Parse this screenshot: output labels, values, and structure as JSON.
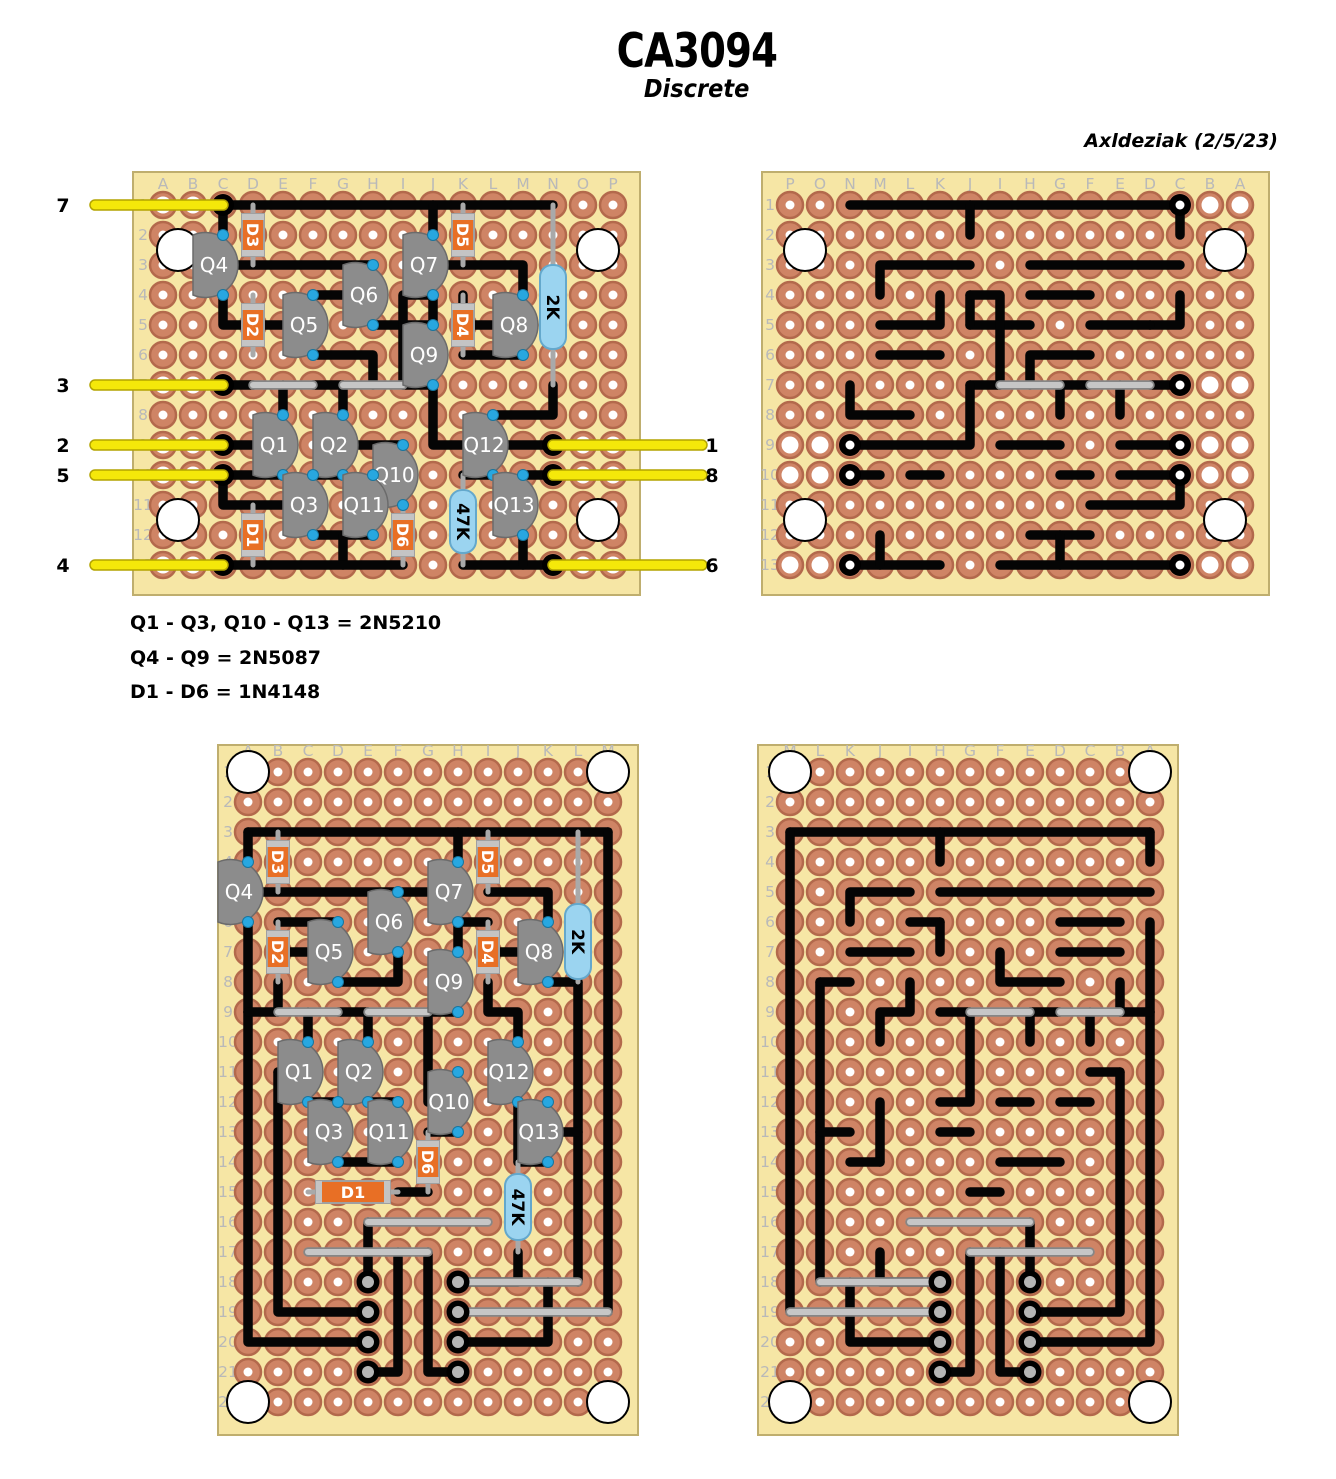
{
  "title": "CA3094",
  "subtitle": "Discrete",
  "author": "Axldeziak (2/5/23)",
  "legend": [
    "Q1 - Q3, Q10 - Q13 = 2N5210",
    "Q4 - Q9 = 2N5087",
    "D1 - D6 = 1N4148"
  ],
  "colors": {
    "board": "#f6e6a5",
    "boardEdge": "#bfae6e",
    "pad": "#cf8465",
    "padEdge": "#b3694c",
    "hole": "#ffffff",
    "trace": "#050505",
    "jumperUnder": "#868686",
    "jumperOver": "#c6c6c6",
    "yellowUnder": "#b3a400",
    "yellowOver": "#f5e80a",
    "transistor": "#8c8c8c",
    "transistorEdge": "#6b6b6b",
    "leadDot": "#28a7e0",
    "leadDotEdge": "#16759f",
    "diodeBody": "#e86f25",
    "diodeEdge": "#a0a0a0",
    "diodeBand": "#c4c4c4",
    "componentLead": "#a9a9a9",
    "resistorBody": "#9bd4f0",
    "resistorEdge": "#64a8cc",
    "terminalCenter": "#b5b5b5",
    "gridLabel": "#b9b9b9",
    "pinLabel": "#000000"
  },
  "boards": [
    {
      "name": "top-left",
      "ox": 133,
      "oy": 172,
      "w": 507,
      "h": 423,
      "cols": "ABCDEFGHIJKLMNOP",
      "nRows": 13,
      "colStart": 163,
      "rowStart": 205,
      "mirror": false,
      "holes": [
        [
          0.5,
          2.5
        ],
        [
          14.5,
          2.5
        ],
        [
          0.5,
          11.5
        ],
        [
          14.5,
          11.5
        ]
      ],
      "wirePads": [
        "A1",
        "B1",
        "A7",
        "B7",
        "A9",
        "B9",
        "O9",
        "P9",
        "A10",
        "B10",
        "O10",
        "P10",
        "A13",
        "B13",
        "O13",
        "P13"
      ],
      "traces": [
        [
          "C1",
          "N1"
        ],
        [
          "C1",
          "C2"
        ],
        [
          "J1",
          "J2"
        ],
        [
          "C3",
          "H3"
        ],
        [
          "J3",
          "M3",
          "M4"
        ],
        [
          "F4",
          "H4"
        ],
        [
          "C4",
          "C5",
          "D5"
        ],
        [
          "D5",
          "F5"
        ],
        [
          "F6",
          "H6",
          "H7"
        ],
        [
          "H5",
          "J5"
        ],
        [
          "J4",
          "J5"
        ],
        [
          "J4",
          "I4",
          "I7"
        ],
        [
          "M5",
          "K5",
          "K4"
        ],
        [
          "K6",
          "M6"
        ],
        [
          "N7",
          "N8",
          "L8"
        ],
        [
          "C7",
          "D7"
        ],
        [
          "F7",
          "G7"
        ],
        [
          "I7",
          "J7"
        ],
        [
          "J7",
          "J9",
          "N9"
        ],
        [
          "E7",
          "E8"
        ],
        [
          "G7",
          "G8"
        ],
        [
          "C9",
          "E9"
        ],
        [
          "G9",
          "I9"
        ],
        [
          "C10",
          "E10"
        ],
        [
          "C10",
          "C11",
          "F11"
        ],
        [
          "N10",
          "M10"
        ],
        [
          "L10",
          "K10"
        ],
        [
          "F10",
          "G10"
        ],
        [
          "F12",
          "H12"
        ],
        [
          "G12",
          "G13"
        ],
        [
          "C13",
          "I13"
        ],
        [
          "K13",
          "N13"
        ],
        [
          "M12",
          "M13"
        ]
      ],
      "jumpers": [
        [
          "D7",
          "F7"
        ],
        [
          "G7",
          "I7"
        ]
      ],
      "grayWires": [],
      "transistors": [
        {
          "l": "Q4",
          "c": "C",
          "r": 2
        },
        {
          "l": "Q7",
          "c": "J",
          "r": 2
        },
        {
          "l": "Q6",
          "c": "H",
          "r": 3
        },
        {
          "l": "Q5",
          "c": "F",
          "r": 4
        },
        {
          "l": "Q8",
          "c": "M",
          "r": 4
        },
        {
          "l": "Q9",
          "c": "J",
          "r": 5
        },
        {
          "l": "Q1",
          "c": "E",
          "r": 8
        },
        {
          "l": "Q2",
          "c": "G",
          "r": 8
        },
        {
          "l": "Q12",
          "c": "L",
          "r": 8
        },
        {
          "l": "Q10",
          "c": "I",
          "r": 9
        },
        {
          "l": "Q3",
          "c": "F",
          "r": 10
        },
        {
          "l": "Q11",
          "c": "H",
          "r": 10
        },
        {
          "l": "Q13",
          "c": "M",
          "r": 10
        }
      ],
      "diodes": [
        {
          "l": "D3",
          "c": "D",
          "r": 1,
          "h": false
        },
        {
          "l": "D5",
          "c": "K",
          "r": 1,
          "h": false
        },
        {
          "l": "D2",
          "c": "D",
          "r": 4,
          "h": false
        },
        {
          "l": "D4",
          "c": "K",
          "r": 4,
          "h": false
        },
        {
          "l": "D1",
          "c": "D",
          "r": 11,
          "h": false
        },
        {
          "l": "D6",
          "c": "I",
          "r": 11,
          "h": false
        }
      ],
      "resistors": [
        {
          "l": "2K",
          "c": "N",
          "r": 1,
          "span": 6,
          "b0": 2.0,
          "b1": 4.8
        },
        {
          "l": "47K",
          "c": "K",
          "r": 10,
          "span": 3,
          "b0": 0.5,
          "b1": 2.6
        }
      ],
      "pins": [
        {
          "l": "7",
          "c": "C",
          "r": 1,
          "s": "L"
        },
        {
          "l": "3",
          "c": "C",
          "r": 7,
          "s": "L"
        },
        {
          "l": "2",
          "c": "C",
          "r": 9,
          "s": "L"
        },
        {
          "l": "5",
          "c": "C",
          "r": 10,
          "s": "L"
        },
        {
          "l": "4",
          "c": "C",
          "r": 13,
          "s": "L"
        },
        {
          "l": "1",
          "c": "N",
          "r": 9,
          "s": "R"
        },
        {
          "l": "8",
          "c": "N",
          "r": 10,
          "s": "R"
        },
        {
          "l": "6",
          "c": "N",
          "r": 13,
          "s": "R"
        }
      ],
      "terminals": []
    },
    {
      "name": "top-right",
      "use": "top-left",
      "ox": 762,
      "oy": 172,
      "w": 507,
      "h": 423,
      "colStart": 790,
      "rowStart": 205,
      "mirror": true,
      "solderDots": [
        "C1",
        "C7",
        "C9",
        "C10",
        "C13",
        "N9",
        "N10",
        "N13"
      ]
    },
    {
      "name": "bottom-left",
      "ox": 218,
      "oy": 745,
      "w": 420,
      "h": 690,
      "cols": "ABCDEFGHIJKLM",
      "nRows": 22,
      "colStart": 248,
      "rowStart": 772,
      "mirror": false,
      "holes": [
        [
          0,
          1
        ],
        [
          12,
          1
        ],
        [
          0,
          22
        ],
        [
          12,
          22
        ]
      ],
      "wirePads": [],
      "traces": [
        [
          "A3",
          "M3"
        ],
        [
          "A3",
          "A4"
        ],
        [
          "H3",
          "H4"
        ],
        [
          "M3",
          "M19"
        ],
        [
          "L8",
          "L18"
        ],
        [
          "A5",
          "H5"
        ],
        [
          "B6",
          "D6"
        ],
        [
          "A6",
          "A9"
        ],
        [
          "A9",
          "A20",
          "E20"
        ],
        [
          "A9",
          "B9"
        ],
        [
          "B7",
          "D7"
        ],
        [
          "B8",
          "B9"
        ],
        [
          "D8",
          "F8",
          "F7"
        ],
        [
          "H6",
          "I6"
        ],
        [
          "H6",
          "H7"
        ],
        [
          "I5",
          "K5",
          "K6"
        ],
        [
          "K7",
          "I7"
        ],
        [
          "K8",
          "L8"
        ],
        [
          "I8",
          "I9",
          "J9",
          "J10"
        ],
        [
          "H9",
          "G9"
        ],
        [
          "G9",
          "G12",
          "H12"
        ],
        [
          "D9",
          "E9"
        ],
        [
          "C9",
          "C10"
        ],
        [
          "E9",
          "E10"
        ],
        [
          "C11",
          "B11"
        ],
        [
          "B11",
          "B19",
          "E19"
        ],
        [
          "C12",
          "D12"
        ],
        [
          "E12",
          "F12"
        ],
        [
          "H13",
          "G13"
        ],
        [
          "D14",
          "F14"
        ],
        [
          "G15",
          "F15"
        ],
        [
          "K13",
          "L13"
        ],
        [
          "J12",
          "J14"
        ],
        [
          "K14",
          "J14"
        ],
        [
          "E16",
          "E18"
        ],
        [
          "G17",
          "G21",
          "H21"
        ],
        [
          "E21",
          "F21",
          "F17"
        ],
        [
          "J17",
          "J18",
          "H18"
        ],
        [
          "H20",
          "K20",
          "K18"
        ]
      ],
      "jumpers": [
        [
          "B9",
          "D9"
        ],
        [
          "E9",
          "G9"
        ],
        [
          "E16",
          "I16"
        ],
        [
          "C17",
          "G17"
        ]
      ],
      "grayWires": [
        [
          "H18",
          "L18"
        ],
        [
          "H19",
          "M19"
        ]
      ],
      "transistors": [
        {
          "l": "Q4",
          "c": "A",
          "r": 4
        },
        {
          "l": "Q7",
          "c": "H",
          "r": 4
        },
        {
          "l": "Q6",
          "c": "F",
          "r": 5
        },
        {
          "l": "Q5",
          "c": "D",
          "r": 6
        },
        {
          "l": "Q8",
          "c": "K",
          "r": 6
        },
        {
          "l": "Q9",
          "c": "H",
          "r": 7
        },
        {
          "l": "Q1",
          "c": "C",
          "r": 10
        },
        {
          "l": "Q2",
          "c": "E",
          "r": 10
        },
        {
          "l": "Q12",
          "c": "J",
          "r": 10
        },
        {
          "l": "Q10",
          "c": "H",
          "r": 11
        },
        {
          "l": "Q3",
          "c": "D",
          "r": 12
        },
        {
          "l": "Q11",
          "c": "F",
          "r": 12
        },
        {
          "l": "Q13",
          "c": "K",
          "r": 12
        }
      ],
      "diodes": [
        {
          "l": "D3",
          "c": "B",
          "r": 3,
          "h": false
        },
        {
          "l": "D5",
          "c": "I",
          "r": 3,
          "h": false
        },
        {
          "l": "D2",
          "c": "B",
          "r": 6,
          "h": false
        },
        {
          "l": "D4",
          "c": "I",
          "r": 6,
          "h": false
        },
        {
          "l": "D6",
          "c": "G",
          "r": 13,
          "h": false
        },
        {
          "l": "D1",
          "c": "C",
          "r": 15,
          "h": true,
          "span": 3
        }
      ],
      "resistors": [
        {
          "l": "2K",
          "c": "L",
          "r": 3,
          "span": 5,
          "b0": 2.4,
          "b1": 4.9
        },
        {
          "l": "47K",
          "c": "J",
          "r": 14,
          "span": 3,
          "b0": 0.4,
          "b1": 2.6
        }
      ],
      "pins": [],
      "terminals": [
        "E18",
        "E19",
        "E20",
        "E21",
        "H18",
        "H19",
        "H20",
        "H21"
      ]
    },
    {
      "name": "bottom-right",
      "use": "bottom-left",
      "ox": 758,
      "oy": 745,
      "w": 420,
      "h": 690,
      "colStart": 790,
      "rowStart": 772,
      "mirror": true,
      "solderDots": []
    }
  ]
}
